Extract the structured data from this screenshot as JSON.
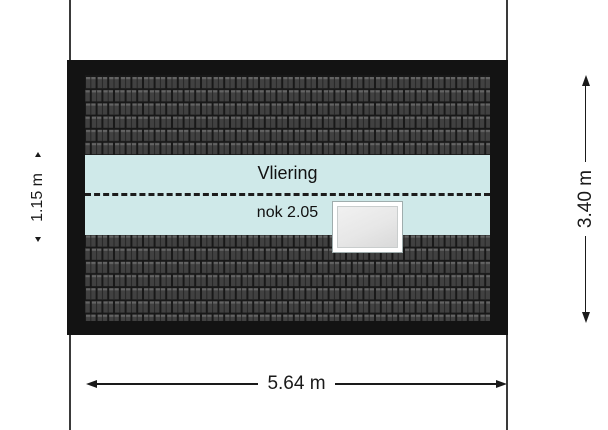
{
  "plan": {
    "room_label": "Vliering",
    "ridge_label": "nok 2.05"
  },
  "dimensions": {
    "left": {
      "label": "1.15 m"
    },
    "right": {
      "label": "3.40 m"
    },
    "bottom": {
      "label": "5.64 m"
    }
  },
  "colors": {
    "background": "#ffffff",
    "roof_frame": "#131313",
    "tile_gap": "#181818",
    "tile_body": "#414141",
    "tile_highlight": "#646464",
    "attic_band": "#cfe9e9",
    "skylight_frame": "#ffffff",
    "skylight_glass": "#e7e7e7",
    "dimension_color": "#1a1a1a"
  },
  "icons": {
    "arrowhead_left": "◀",
    "arrowhead_right": "▶",
    "arrowhead_up": "▲",
    "arrowhead_down": "▼",
    "tick_top": "▴",
    "tick_bottom": "▾"
  }
}
